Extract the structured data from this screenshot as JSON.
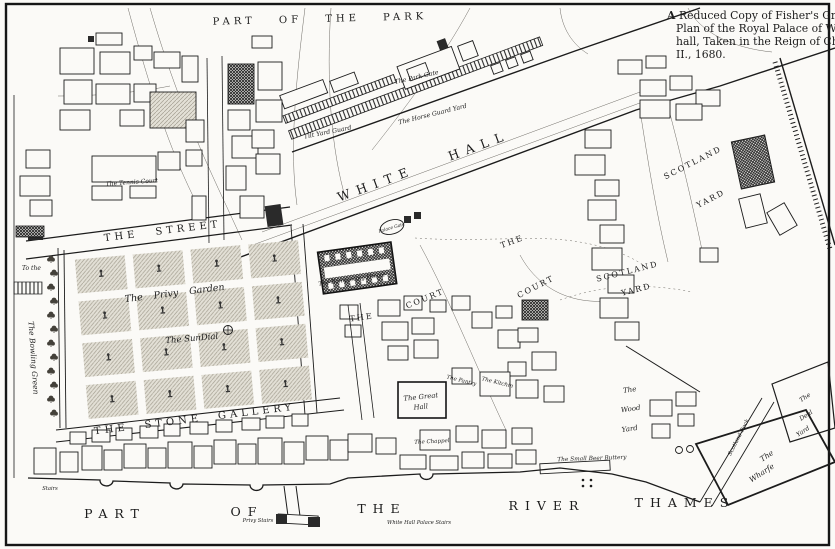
{
  "title": {
    "initial": "A",
    "line1_rest": "Reduced Copy of Fisher's Ground",
    "line2": "Plan of the Royal Palace of White-",
    "line3": "hall, Taken in the Reign of Charles",
    "line4": "II., 1680."
  },
  "areas": {
    "park": "PART OF THE PARK",
    "white_hall": "WHITE HALL",
    "the_street": "THE STREET",
    "privy_garden": "The Privy Garden",
    "sundial": "The SunDial",
    "stone_gallery": "THE STONE GALLERY",
    "bowling_green": "The Bowling Green",
    "to_the": "To the",
    "court1_the": "THE",
    "court1": "COURT",
    "court2_the": "THE",
    "court2": "COURT",
    "scotland1_l1": "SCOTLAND",
    "scotland1_l2": "YARD",
    "scotland2_l1": "SCOTLAND",
    "scotland2_l2": "YARD"
  },
  "buildings": {
    "park_gate": "The Park Gate",
    "horse_guard_yard": "The Horse Guard Yard",
    "tilt_yard_guard": "Tilt Yard Guard",
    "tennis_court": "The Tennis Court",
    "banqueting_house": "The Banqueting House",
    "palace_gate": "Palace Gate",
    "great_hall_l1": "The Great",
    "great_hall_l2": "Hall",
    "pantry": "The Pantry",
    "kitchin": "The Kitchin",
    "chappel": "The Chappel",
    "buttery": "The Small Beer Buttery",
    "wood_yard_l1": "The",
    "wood_yard_l2": "Wood",
    "wood_yard_l3": "Yard",
    "deal_yard_l1": "The",
    "deal_yard_l2": "Deal",
    "deal_yard_l3": "Yard",
    "wharfe_l1": "The",
    "wharfe_l2": "Wharfe",
    "scotland_dock": "Scotland Dock"
  },
  "river": {
    "w1": "PART",
    "w2": "OF",
    "w3": "THE",
    "w4": "RIVER",
    "w5": "THAMES"
  },
  "stairs": {
    "privy": "Privy Stairs",
    "whitehall": "White Hall Palace Stairs",
    "left": "Stairs"
  },
  "colors": {
    "ink": "#1c1c1c",
    "paper": "#fbfaf7"
  }
}
